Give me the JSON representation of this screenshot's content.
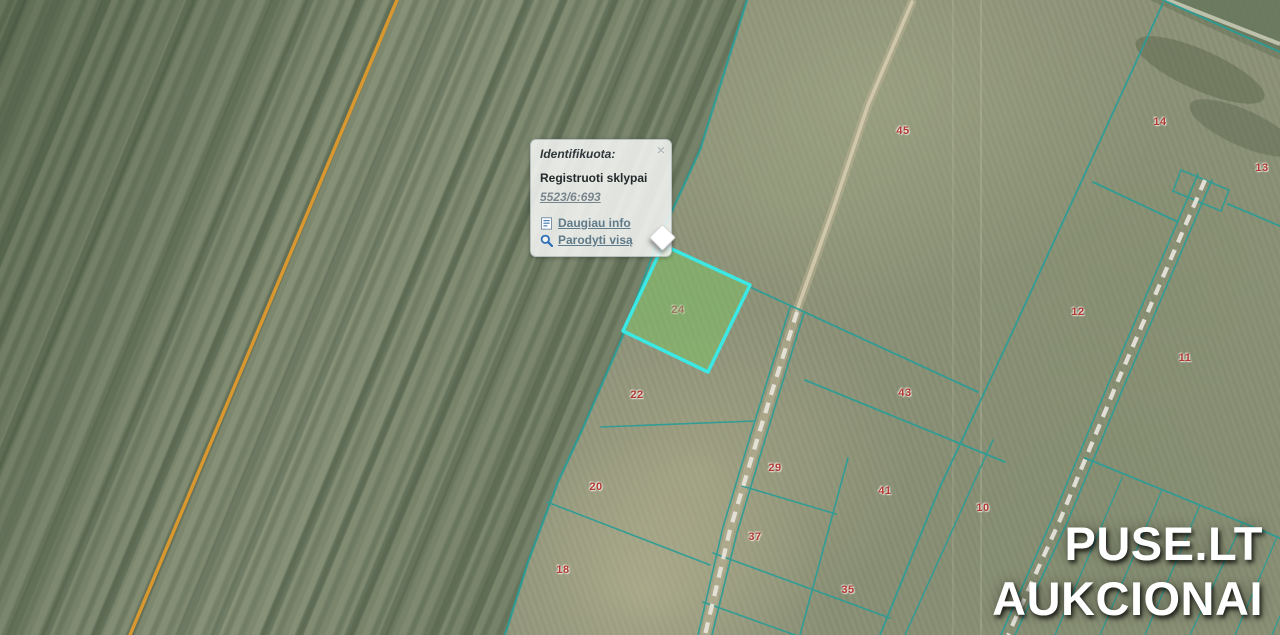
{
  "popup": {
    "title": "Identifikuota:",
    "close": "×",
    "result_layer": "Registruoti sklypai",
    "feature_id": "5523/6:693",
    "links": [
      {
        "label": "Daugiau info",
        "icon": "info-page-icon"
      },
      {
        "label": "Parodyti visą",
        "icon": "magnifier-icon"
      }
    ]
  },
  "watermark": {
    "line1": "PUSE.LT",
    "line2": "AUKCIONAI"
  },
  "map": {
    "selected_parcel": "24",
    "colors": {
      "parcel_line": "#2a9d96",
      "selected_outline": "#3be8e4",
      "selected_fill": "#7cc463",
      "field_boundary_orange": "#e09b2d",
      "parcel_number": "#b13a33",
      "road_dash": "#e6e4da",
      "dirt_track": "#b7ae92"
    },
    "parcel_labels": [
      {
        "text": "45",
        "x": 903,
        "y": 131
      },
      {
        "text": "14",
        "x": 1160,
        "y": 122
      },
      {
        "text": "13",
        "x": 1262,
        "y": 168
      },
      {
        "text": "12",
        "x": 1078,
        "y": 312
      },
      {
        "text": "11",
        "x": 1185,
        "y": 358
      },
      {
        "text": "24",
        "x": 678,
        "y": 310,
        "selected": true
      },
      {
        "text": "22",
        "x": 637,
        "y": 395
      },
      {
        "text": "43",
        "x": 905,
        "y": 393
      },
      {
        "text": "29",
        "x": 775,
        "y": 468
      },
      {
        "text": "41",
        "x": 885,
        "y": 491
      },
      {
        "text": "20",
        "x": 596,
        "y": 487
      },
      {
        "text": "37",
        "x": 755,
        "y": 537
      },
      {
        "text": "18",
        "x": 563,
        "y": 570
      },
      {
        "text": "35",
        "x": 848,
        "y": 590
      },
      {
        "text": "10",
        "x": 983,
        "y": 508
      },
      {
        "text": "9",
        "x": 1105,
        "y": 553
      }
    ]
  }
}
